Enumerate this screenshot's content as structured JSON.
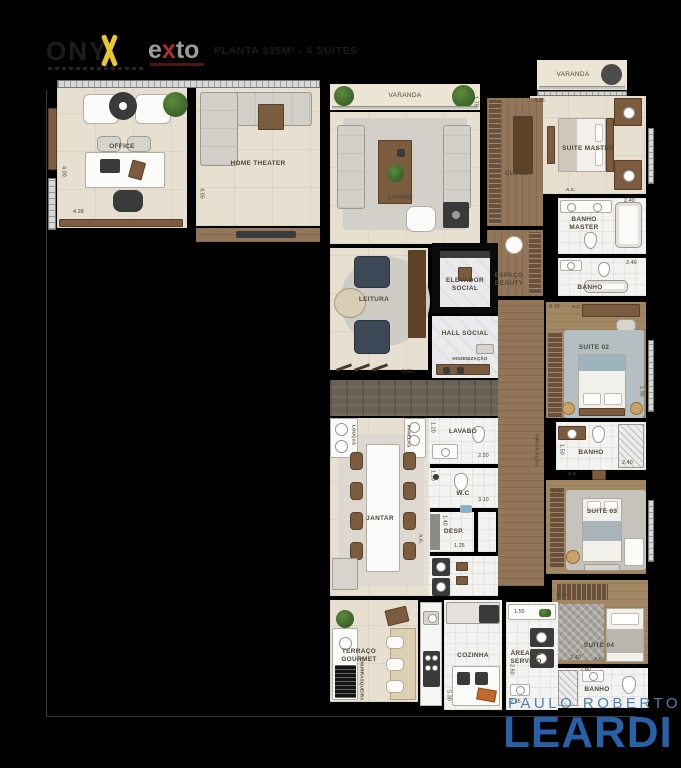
{
  "header": {
    "project": {
      "prefix": "ONY",
      "accent": "X"
    },
    "developer": {
      "e": "e",
      "x": "x",
      "to": "to"
    },
    "subtitle": "PLANTA 335M² - 4 SUÍTES"
  },
  "footer": {
    "agent_name": "PAULO ROBERTO",
    "brand": "LEARDI"
  },
  "colors": {
    "accent_yellow": "#e8c832",
    "exto_red": "#a2342a",
    "leardi_blue": "#2b67b0",
    "leardi_name_blue": "#4d80b6"
  },
  "rooms": {
    "office": {
      "label": "OFFICE"
    },
    "home_theater": {
      "label": "HOME THEATER"
    },
    "varanda": {
      "label": "VARANDA"
    },
    "living": {
      "label": "LIVING"
    },
    "varanda_suite": {
      "label": "VARANDA"
    },
    "suite_master": {
      "label": "SUITE MASTER"
    },
    "closet": {
      "label": "CLOSET"
    },
    "banho_master": {
      "label": "BANHO MASTER"
    },
    "banho_master_2": {
      "label": "BANHO"
    },
    "espaco_beauty": {
      "label": "ESPAÇO BEAUTY"
    },
    "leitura": {
      "label": "LEITURA"
    },
    "elevador_social": {
      "label": "ELEVADOR SOCIAL"
    },
    "hall_social": {
      "label": "HALL SOCIAL",
      "sublabel": "HIGIENIZAÇÃO"
    },
    "jantar": {
      "label": "JANTAR"
    },
    "lavabo": {
      "label": "LAVABO"
    },
    "wc": {
      "label": "W.C"
    },
    "despensa": {
      "label": "DESP."
    },
    "suite_02": {
      "label": "SUITE 02"
    },
    "banho_suite_02": {
      "label": "BANHO"
    },
    "circulacao": {
      "label": "CIRCULAÇÃO"
    },
    "suite_03": {
      "label": "SUITE 03"
    },
    "suite_04": {
      "label": "SUITE 04"
    },
    "banho_suite_04": {
      "label": "BANHO"
    },
    "terraco_gourmet": {
      "label": "TERRAÇO GOURMET",
      "sublabel": "CHURRASQUEIRA"
    },
    "cozinha": {
      "label": "COZINHA"
    },
    "area_servico": {
      "label": "ÁREA DE SERVIÇO"
    },
    "cab_loucas": "LOUÇAS",
    "cab_panelas": "PANELAS",
    "ac": "A.C."
  },
  "dimensions": {
    "office_width": "4.28",
    "office_height": "4.00",
    "home_theater_height": "4.05",
    "varanda_height": "1.75",
    "closet_width": "4.85",
    "banho_master_width": "2.40",
    "banho2_width": "2.40",
    "hall_width": "3.00",
    "lavabo_height": "1.20",
    "lavabo_width": "2.20",
    "wc_height": "1.10",
    "wc_width": "3.10",
    "desp_height": "1.40",
    "desp_width": "1.25",
    "suite02_width": "3.10",
    "suite02_height": "1.90",
    "banho02_height": "1.50",
    "banho02_width": "2.40",
    "suite03_width": "3.10",
    "suite04_top": "4.30",
    "suite04_width": "2.40",
    "banho04_width": "2.80",
    "cozinha_height": "5.30",
    "servico_top": "1.55",
    "servico_height": "2.60",
    "servico_width": "2.45"
  }
}
